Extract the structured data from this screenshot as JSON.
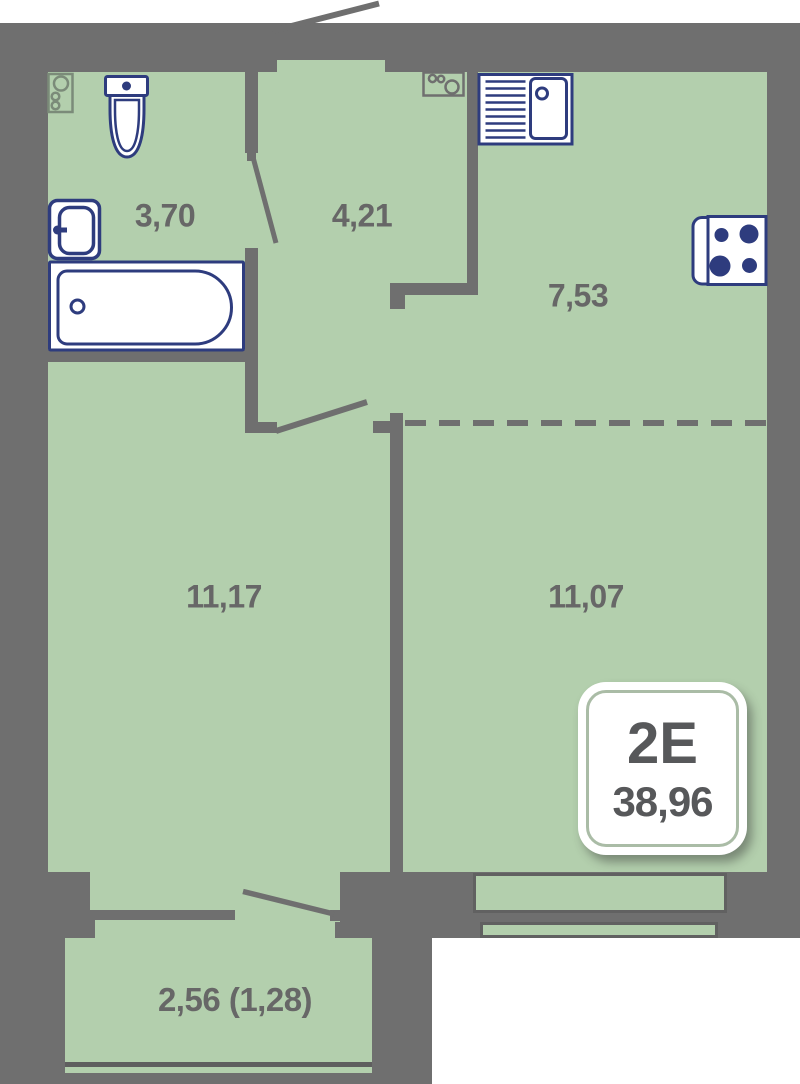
{
  "floor_plan": {
    "unit_type": "2E",
    "total_area": "38,96",
    "rooms": [
      {
        "id": "bathroom",
        "area": "3,70"
      },
      {
        "id": "hallway",
        "area": "4,21"
      },
      {
        "id": "kitchen",
        "area": "7,53"
      },
      {
        "id": "room-1",
        "area": "11,17"
      },
      {
        "id": "room-2",
        "area": "11,07"
      },
      {
        "id": "balcony",
        "area": "2,56 (1,28)"
      }
    ],
    "fixtures": [
      "washing-machine-icon",
      "toilet-icon",
      "sink-icon",
      "bathtub-icon",
      "kitchen-sink-icon",
      "stove-icon",
      "appliance-icon"
    ],
    "colors": {
      "wall": "#6f6f6f",
      "floor": "#b3cfad",
      "fixture_outline": "#2e3c7e",
      "label_text": "#676767",
      "badge_text": "#57585a",
      "badge_frame": "#aabca6"
    }
  }
}
